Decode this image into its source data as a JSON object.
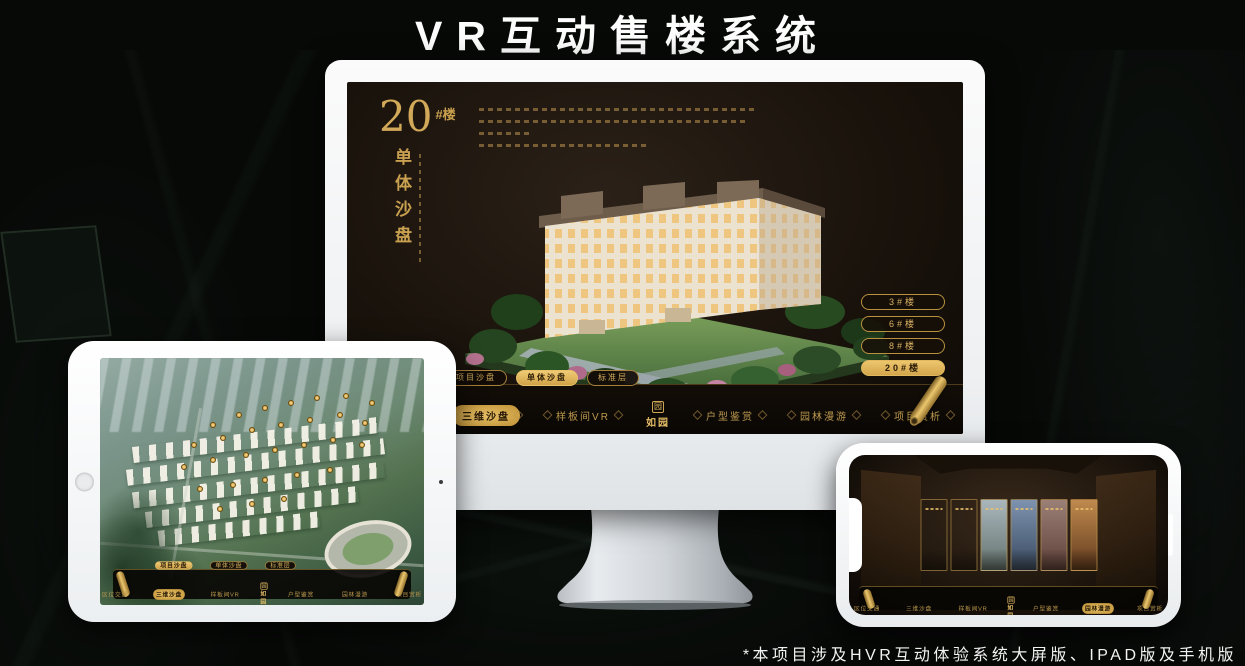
{
  "page": {
    "title": "VR互动售楼系统",
    "footnote": "*本项目涉及HVR互动体验系统大屏版、IPAD版及手机版"
  },
  "brand": {
    "logo_text": "如园",
    "logo_mark": "园"
  },
  "colors": {
    "gold": "#C9A050",
    "gold_bright": "#E6BE6A",
    "selected_fill": "#DCAF5C",
    "screen_bg": "#1B140D",
    "navbar_bg": "#0B0805",
    "device_frame": "#F4F5F6"
  },
  "app_nav": {
    "items": [
      {
        "label": "区位交通"
      },
      {
        "label": "三维沙盘"
      },
      {
        "label": "样板间VR"
      },
      {
        "label": "户型鉴赏"
      },
      {
        "label": "园林漫游"
      },
      {
        "label": "项目赏析"
      }
    ]
  },
  "monitor": {
    "hero": {
      "number": "20",
      "suffix": "#楼",
      "vertical_title": "单体沙盘"
    },
    "tabs": [
      {
        "label": "项目沙盘",
        "selected": false
      },
      {
        "label": "单体沙盘",
        "selected": true
      },
      {
        "label": "标准层",
        "selected": false
      }
    ],
    "floor_buttons": [
      {
        "label": "3#楼",
        "selected": false
      },
      {
        "label": "6#楼",
        "selected": false
      },
      {
        "label": "8#楼",
        "selected": false
      },
      {
        "label": "20#楼",
        "selected": true
      }
    ],
    "nav_selected": "三维沙盘"
  },
  "tablet": {
    "tabs": [
      {
        "label": "项目沙盘",
        "selected": true
      },
      {
        "label": "单体沙盘",
        "selected": false
      },
      {
        "label": "标准层",
        "selected": false
      }
    ],
    "nav_selected": "三维沙盘",
    "markers": [
      [
        34,
        26
      ],
      [
        42,
        22
      ],
      [
        50,
        19
      ],
      [
        58,
        17
      ],
      [
        66,
        15
      ],
      [
        75,
        14
      ],
      [
        83,
        17
      ],
      [
        28,
        34
      ],
      [
        37,
        31
      ],
      [
        46,
        28
      ],
      [
        55,
        26
      ],
      [
        64,
        24
      ],
      [
        73,
        22
      ],
      [
        81,
        25
      ],
      [
        25,
        43
      ],
      [
        34,
        40
      ],
      [
        44,
        38
      ],
      [
        53,
        36
      ],
      [
        62,
        34
      ],
      [
        71,
        32
      ],
      [
        80,
        34
      ],
      [
        30,
        52
      ],
      [
        40,
        50
      ],
      [
        50,
        48
      ],
      [
        60,
        46
      ],
      [
        70,
        44
      ],
      [
        36,
        60
      ],
      [
        46,
        58
      ],
      [
        56,
        56
      ]
    ]
  },
  "phone": {
    "nav_selected": "园林漫游",
    "gallery": [
      {
        "name": "interior-grey",
        "c1": "#9A9D9B",
        "c2": "#54575四"
      },
      {
        "name": "courtyard-green",
        "c1": "#8D9B8D",
        "c2": "#47534六"
      },
      {
        "name": "exterior-sky",
        "c1": "#AAB6BD",
        "c2": "#64736D"
      },
      {
        "name": "building-blue",
        "c1": "#7E93B0",
        "c2": "#394A60"
      },
      {
        "name": "autumn-red",
        "c1": "#9B8078",
        "c2": "#5E4038"
      },
      {
        "name": "interior-warm",
        "c1": "#C08A4E",
        "c2": "#613A1D"
      }
    ]
  }
}
